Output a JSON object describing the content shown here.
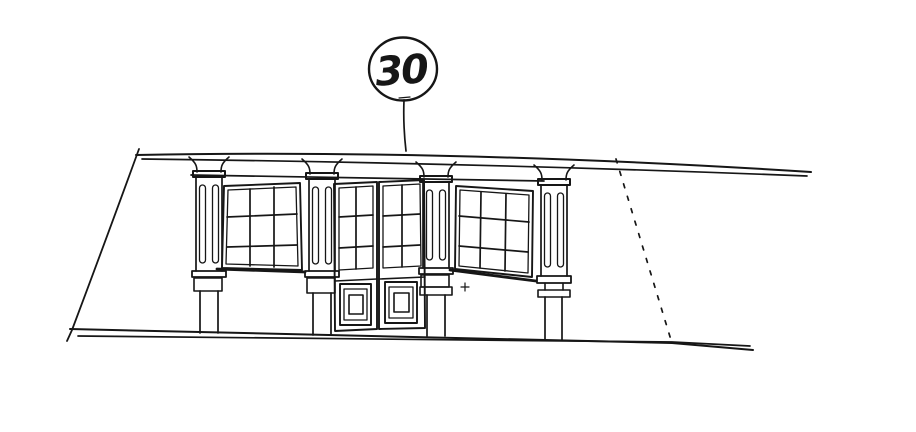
{
  "drawing": {
    "callout": {
      "number": "30"
    },
    "ink_color": "#161616",
    "paper_color": "#ffffff"
  }
}
